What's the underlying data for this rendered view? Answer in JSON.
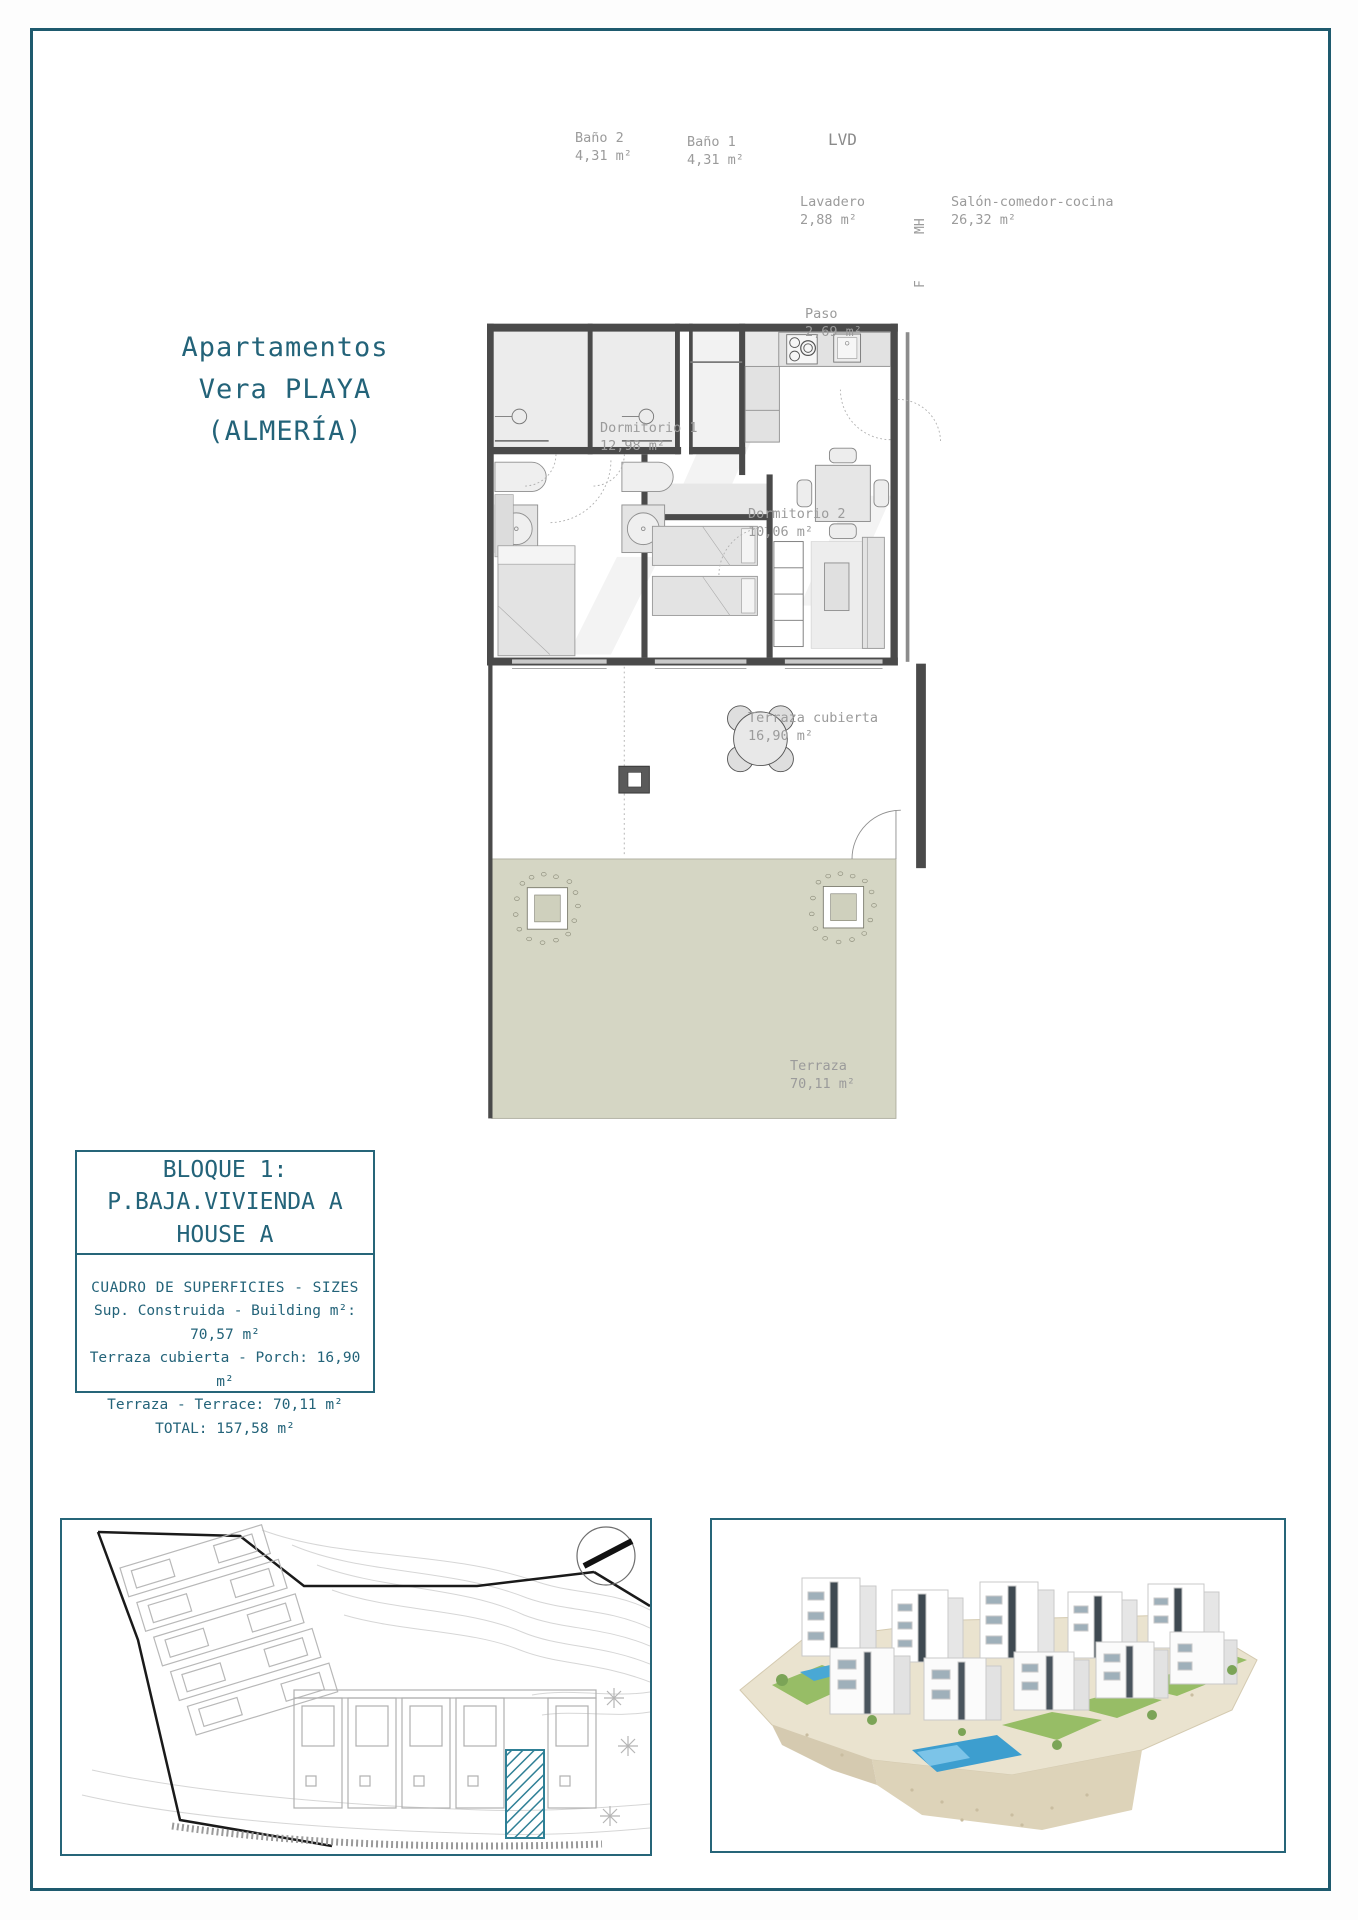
{
  "colors": {
    "accent_teal": "#236379",
    "frame_teal": "#1e5a6e",
    "hatch_teal": "#2f8096",
    "terrace_green": "#d5d6c4",
    "wall_gray": "#4a4a4a"
  },
  "header": {
    "title_line1": "Apartamentos",
    "title_line2": "Vera PLAYA",
    "title_line3": "(ALMERÍA)"
  },
  "floor_plan": {
    "rooms": {
      "bano2": {
        "name": "Baño 2",
        "area": "4,31 m²"
      },
      "bano1": {
        "name": "Baño 1",
        "area": "4,31 m²"
      },
      "lvd": {
        "name": "LVD"
      },
      "lavadero": {
        "name": "Lavadero",
        "area": "2,88 m²"
      },
      "salon": {
        "name": "Salón-comedor-cocina",
        "area": "26,32 m²"
      },
      "paso": {
        "name": "Paso",
        "area": "2,69 m²"
      },
      "dormitorio1": {
        "name": "Dormitorio 1",
        "area": "12,98 m²"
      },
      "dormitorio2": {
        "name": "Dormitorio 2",
        "area": "10,06 m²"
      },
      "terraza_cubierta": {
        "name": "Terraza cubierta",
        "area": "16,90 m²"
      },
      "terraza": {
        "name": "Terraza",
        "area": "70,11 m²"
      }
    },
    "appliances": {
      "mh": "MH",
      "f": "F"
    }
  },
  "info_box": {
    "line1": "BLOQUE 1:",
    "line2": "P.BAJA.VIVIENDA A",
    "line3": "HOUSE A",
    "sizes_heading": "CUADRO DE SUPERFICIES  - SIZES",
    "row_building": "Sup. Construida  - Building m²: 70,57 m²",
    "row_porch": "Terraza cubierta  - Porch: 16,90 m²",
    "row_terrace": "Terraza - Terrace: 70,11 m²",
    "row_total": "TOTAL:  157,58 m²"
  }
}
